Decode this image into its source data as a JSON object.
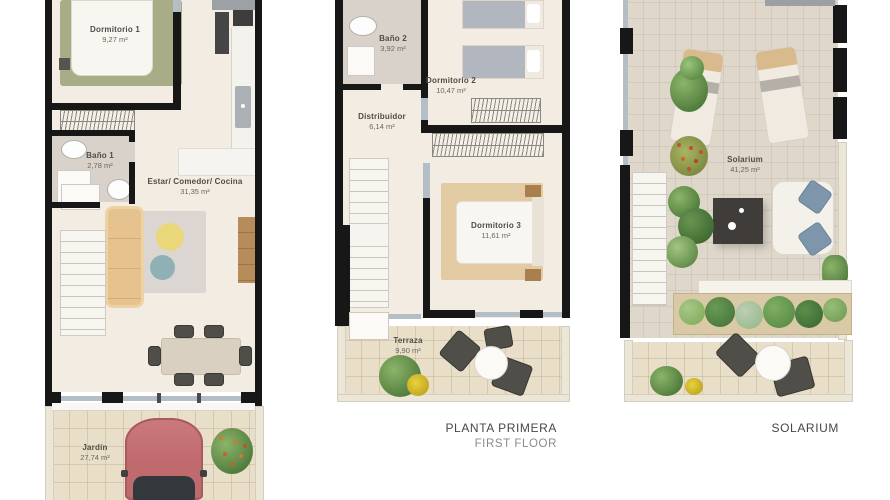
{
  "captions": {
    "first_floor_title": "PLANTA PRIMERA",
    "first_floor_subtitle": "FIRST FLOOR",
    "solarium_title": "SOLARIUM"
  },
  "ground_floor": {
    "dormitorio1": {
      "name": "Dormitorio 1",
      "area": "9,27 m²"
    },
    "bano1": {
      "name": "Baño 1",
      "area": "2,78 m²"
    },
    "living": {
      "name": "Estar/ Comedor/ Cocina",
      "area": "31,35 m²"
    },
    "jardin": {
      "name": "Jardín",
      "area": "27,74 m²"
    }
  },
  "first_floor": {
    "bano2": {
      "name": "Baño 2",
      "area": "3,92 m²"
    },
    "dormitorio2": {
      "name": "Dormitorio 2",
      "area": "10,47 m²"
    },
    "distribuidor": {
      "name": "Distribuidor",
      "area": "6,14 m²"
    },
    "dormitorio3": {
      "name": "Dormitorio 3",
      "area": "11,61 m²"
    },
    "terraza": {
      "name": "Terraza",
      "area": "9,90 m²"
    }
  },
  "solarium_floor": {
    "solarium": {
      "name": "Solarium",
      "area": "41,25 m²"
    }
  },
  "colors": {
    "wall": "#171717",
    "floor_cream": "#f2ece2",
    "bath_floor": "#d8d2ca",
    "bedroom_rug_green": "#a9ad87",
    "sofa_tan": "#e6c28f",
    "pouf_yellow": "#e9d77a",
    "pouf_blue": "#8fb1b6",
    "wood": "#b78c5b",
    "tile_warm": "#e9dfc9",
    "tile_gray": "#ded7ca",
    "car_red": "#c06a6d",
    "bed_cover_gray": "#b2b6be",
    "dorm3_rug_tan": "#e2cba3",
    "cushion_blue": "#7d96ab",
    "plant_green": "#6e9c50",
    "dark_table": "#3f3c39",
    "glass": "#b3bec6"
  }
}
